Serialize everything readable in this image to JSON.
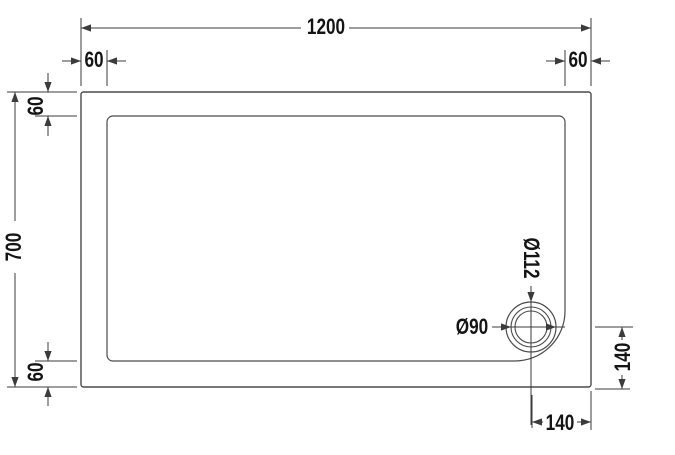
{
  "labels": {
    "overall_width": "1200",
    "inset_top_left": "60",
    "inset_top_right": "60",
    "overall_depth": "700",
    "inset_left_top": "60",
    "inset_left_bottom": "60",
    "waste_outer_diameter": "Ø112",
    "waste_inner_diameter": "Ø90",
    "waste_offset_from_bottom": "140",
    "waste_offset_from_right": "140"
  },
  "colors": {
    "background": "#ffffff",
    "tray_outline": "#4a4a4a",
    "dimension_lines": "#3b3b3b",
    "text": "#141414"
  }
}
